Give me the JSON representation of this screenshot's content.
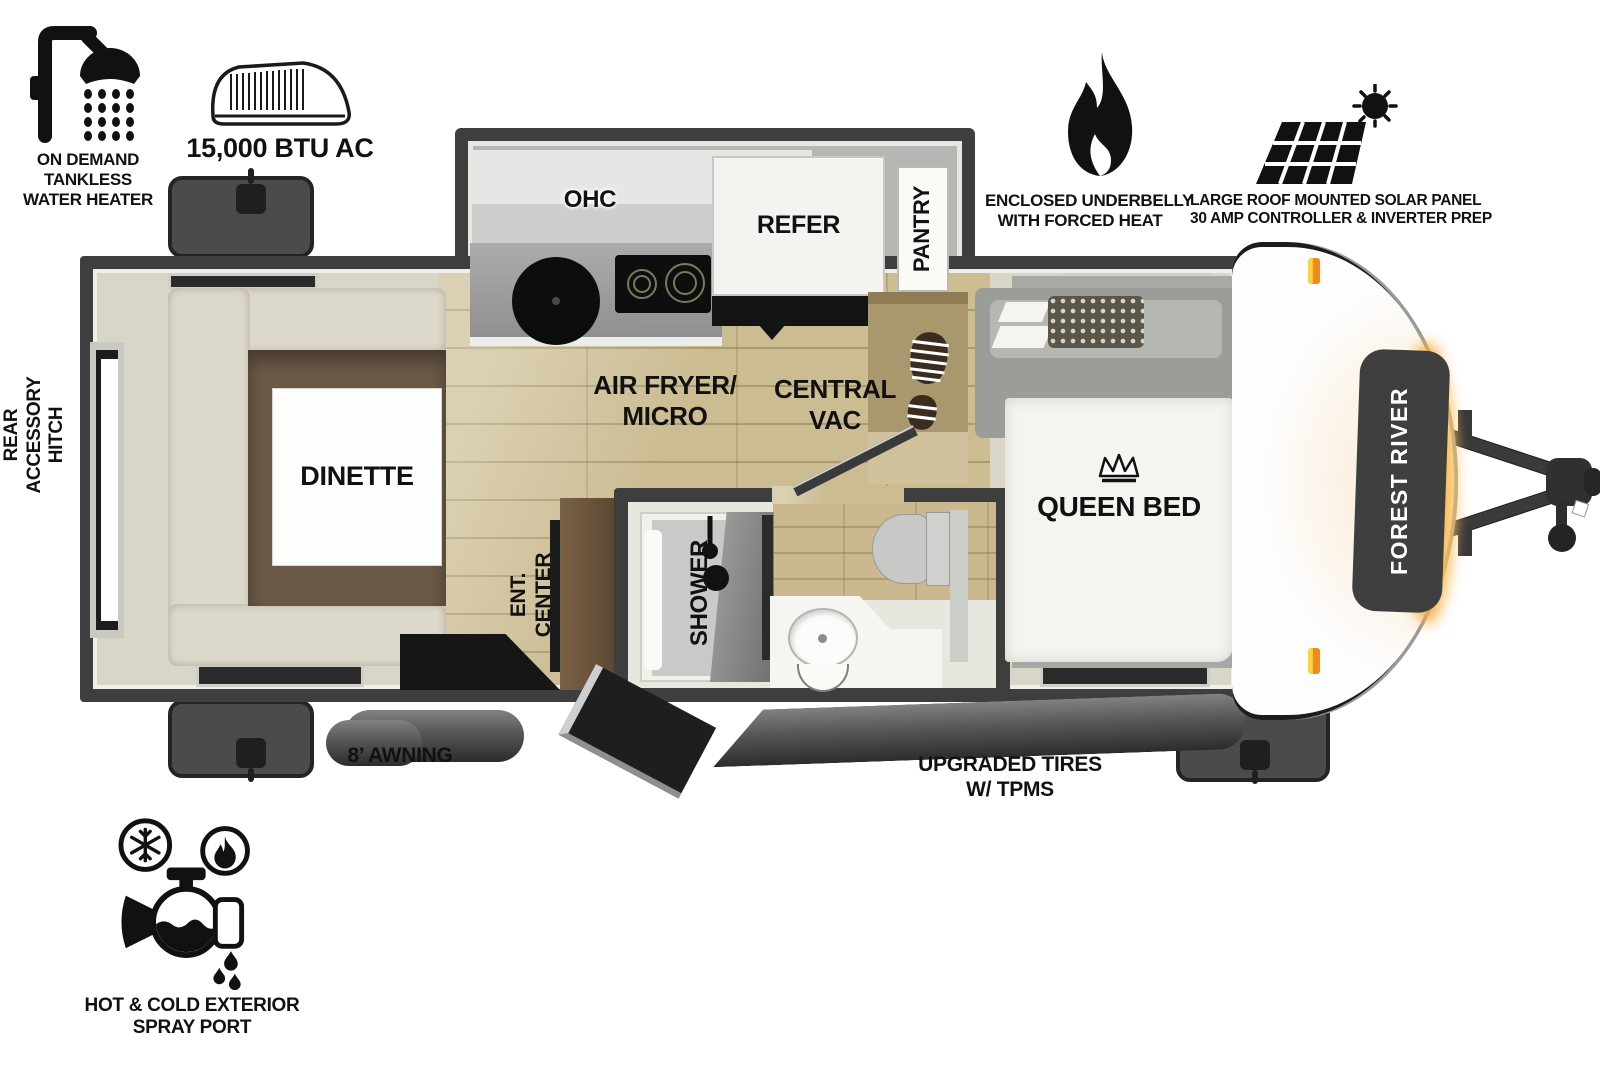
{
  "features": {
    "water_heater": {
      "lines": [
        "ON DEMAND",
        "TANKLESS",
        "WATER HEATER"
      ]
    },
    "ac": {
      "label": "15,000 BTU AC"
    },
    "underbelly": {
      "lines": [
        "ENCLOSED UNDERBELLY",
        "WITH FORCED HEAT"
      ]
    },
    "solar": {
      "lines": [
        "LARGE ROOF MOUNTED SOLAR PANEL",
        "30 AMP CONTROLLER & INVERTER PREP"
      ]
    },
    "spray_port": {
      "lines": [
        "HOT & COLD EXTERIOR",
        "SPRAY PORT"
      ]
    },
    "awning": {
      "label": "8’ AWNING"
    },
    "tires": {
      "lines": [
        "UPGRADED TIRES",
        "W/ TPMS"
      ]
    },
    "rear_hitch": {
      "lines": [
        "REAR",
        "ACCESSORY",
        "HITCH"
      ]
    }
  },
  "rooms": {
    "dinette": "DINETTE",
    "ohc": "OHC",
    "refer": "REFER",
    "pantry": "PANTRY",
    "air_fryer": {
      "lines": [
        "AIR FRYER/",
        "MICRO"
      ]
    },
    "central_vac": {
      "lines": [
        "CENTRAL",
        "VAC"
      ]
    },
    "ent_center": {
      "lines": [
        "ENT.",
        "CENTER"
      ]
    },
    "shower": "SHOWER",
    "queen_bed": "QUEEN BED"
  },
  "brand": {
    "label": "FOREST RIVER"
  },
  "colors": {
    "wall": "#3e3e3e",
    "floor_wood": "#cbbc92",
    "interior_beige": "#dad6c7",
    "accent_orange": "#f5a93e",
    "marker_light": "#ef8b1c"
  }
}
